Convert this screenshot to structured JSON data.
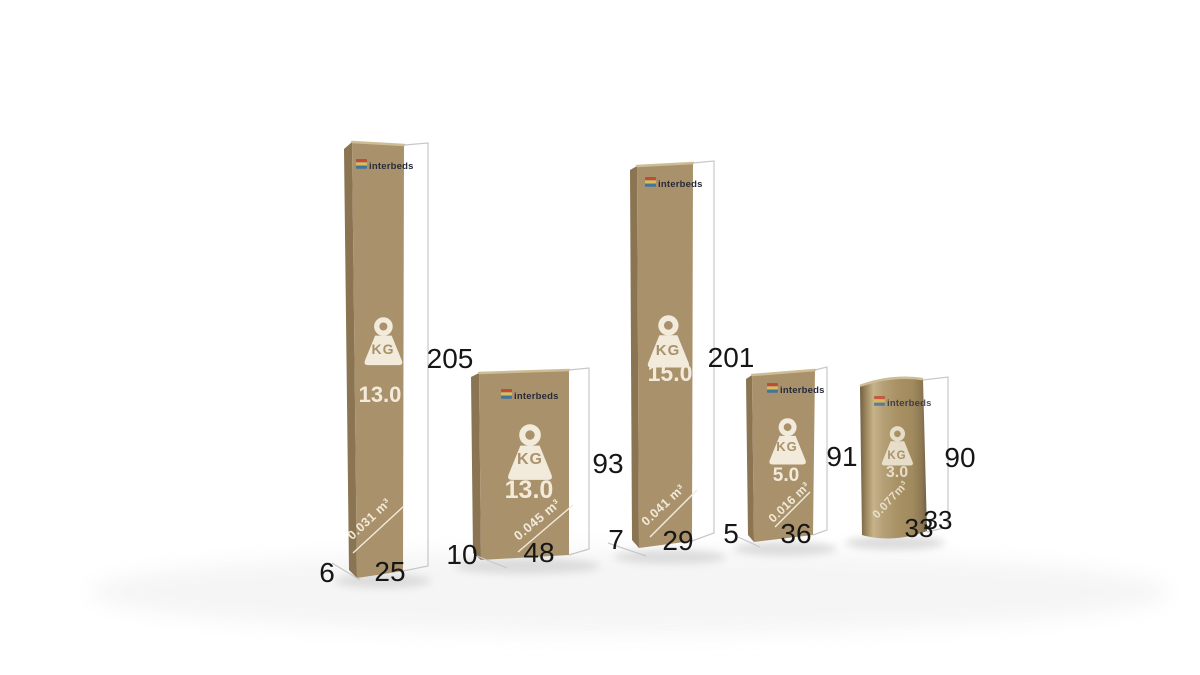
{
  "scene": {
    "description": "Five cardboard packages compared by size with printed weight, volume and outer dimensions"
  },
  "icons": {
    "logo": "interbeds-layers-icon",
    "weight": "kg-weight-icon"
  },
  "colors": {
    "box-front": "#a9926b",
    "box-side": "#8a7451",
    "box-top": "#cdbd94",
    "print": "#f2ebdb",
    "label": "#161616",
    "wire": "#c7c7c7",
    "logo-text": "#262b3a",
    "logo-red": "#c24a39",
    "logo-yellow": "#e0bb51",
    "logo-blue": "#41749e",
    "shadow": "#dcdcdc",
    "bg": "#ffffff"
  },
  "packages": [
    {
      "name": "tall-slim-box",
      "logo_text": "interbeds",
      "weight_unit": "KG",
      "weight_value": "13.0",
      "volume": "0.031 m³",
      "dims": {
        "height": "205",
        "depth": "6",
        "width": "25"
      }
    },
    {
      "name": "short-wide-box",
      "logo_text": "interbeds",
      "weight_unit": "KG",
      "weight_value": "13.0",
      "volume": "0.045 m³",
      "dims": {
        "height": "93",
        "depth": "10",
        "width": "48"
      }
    },
    {
      "name": "tall-medium-box",
      "logo_text": "interbeds",
      "weight_unit": "KG",
      "weight_value": "15.0",
      "volume": "0.041 m³",
      "dims": {
        "height": "201",
        "depth": "7",
        "width": "29"
      }
    },
    {
      "name": "small-box",
      "logo_text": "interbeds",
      "weight_unit": "KG",
      "weight_value": "5.0",
      "volume": "0.016 m³",
      "dims": {
        "height": "91",
        "depth": "5",
        "width": "36"
      }
    },
    {
      "name": "rolled-cylinder-pack",
      "logo_text": "interbeds",
      "weight_unit": "KG",
      "weight_value": "3.0",
      "volume": "0.077m³",
      "dims": {
        "height": "90",
        "depth": "33",
        "width": "33"
      }
    }
  ]
}
